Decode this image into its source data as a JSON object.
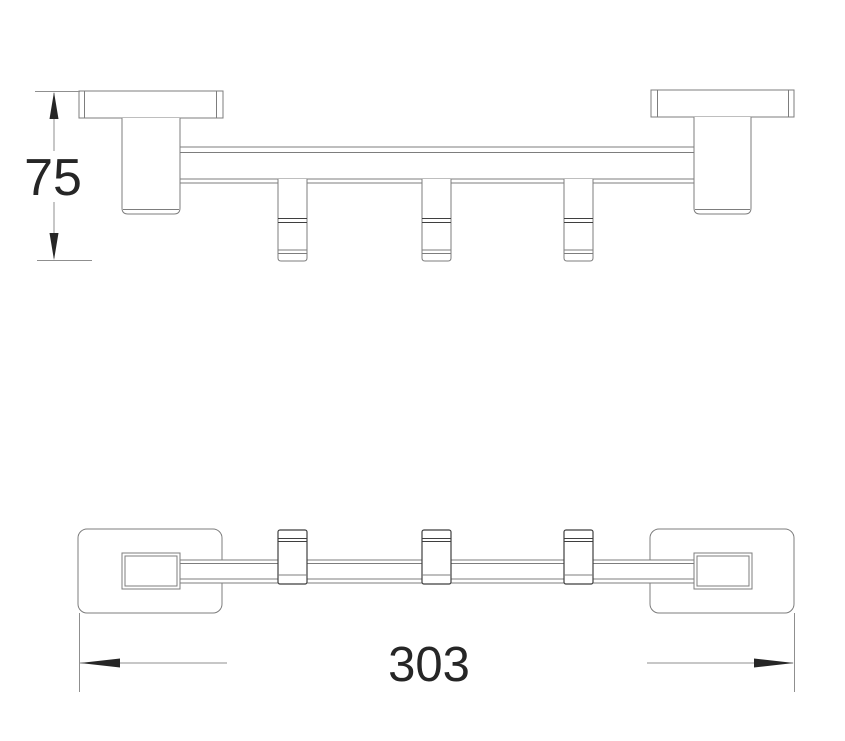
{
  "drawing": {
    "kind": "orthographic-technical-drawing",
    "views": {
      "side_elevation": {
        "hook_count": 3,
        "mount_count": 2
      },
      "top_plan": {
        "hook_count": 3,
        "mount_count": 2
      }
    },
    "dimensions": {
      "height": {
        "label": "75"
      },
      "width": {
        "label": "303"
      }
    },
    "colors": {
      "background": "#ffffff",
      "line": "#7d7d7d",
      "accent_line": "#3f3f3f",
      "dimension_line": "#8f8f8f",
      "dimension_text": "#262626"
    }
  }
}
